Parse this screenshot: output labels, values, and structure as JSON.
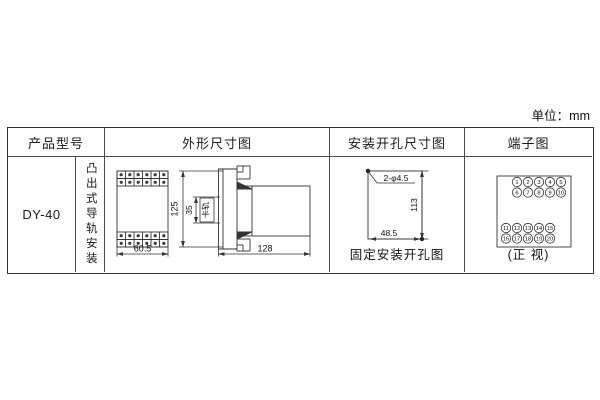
{
  "unit_label": "单位：mm",
  "table": {
    "headers": {
      "product_model": "产品型号",
      "outline": "外形尺寸图",
      "mounting_holes": "安装开孔尺寸图",
      "terminals": "端子图"
    },
    "product_model": "DY-40",
    "mounting_type": "凸出式导轨安装"
  },
  "outline_drawing": {
    "front_width": "60.5",
    "height": "125",
    "rail_slot": "35",
    "rail_slot_label": "卡轨",
    "depth": "128"
  },
  "mounting_hole_drawing": {
    "holes_label": "2-φ4.5",
    "vertical_pitch": "113",
    "horizontal_pitch": "48.5",
    "caption": "固定安装开孔图"
  },
  "terminal_diagram": {
    "caption": "(正 视)",
    "top_rows": [
      [
        "1",
        "2",
        "3",
        "4",
        "5"
      ],
      [
        "6",
        "7",
        "8",
        "9",
        "10"
      ]
    ],
    "bottom_rows": [
      [
        "11",
        "12",
        "13",
        "14",
        "15"
      ],
      [
        "16",
        "17",
        "18",
        "19",
        "20"
      ]
    ]
  }
}
